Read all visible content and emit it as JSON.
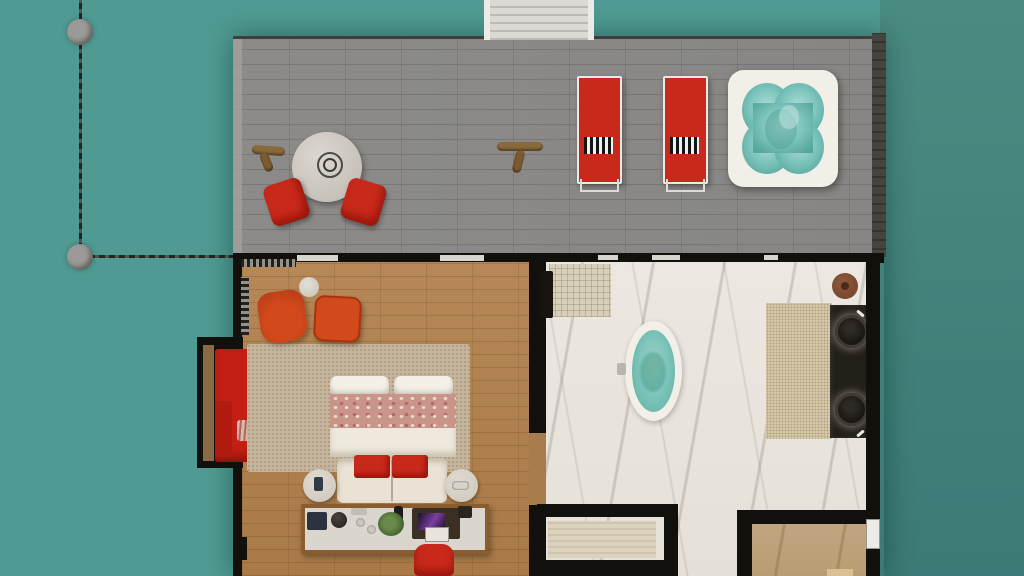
{
  "canvas": {
    "width": 1024,
    "height": 576
  },
  "scene_type": "overwater-villa-top-down-floor-plan-render",
  "inventory": {
    "water": [
      "pier-railing",
      "mooring-pile",
      "mooring-pile"
    ],
    "sun_deck": [
      "entry-staircase",
      "dock-cleat",
      "dock-cleat",
      "bistro-table",
      "cube-chair",
      "cube-chair",
      "sun-lounger",
      "sun-lounger",
      "towel",
      "towel",
      "hot-tub"
    ],
    "bedroom": [
      "sliding-door-gap",
      "sliding-door-gap",
      "blind-hatch",
      "armchair",
      "ottoman",
      "side-table",
      "window-alcove",
      "chaise-lounge",
      "chaise-pillow",
      "round-side-table",
      "area-rug",
      "double-bed",
      "pillow",
      "pillow",
      "floral-runner",
      "duvet",
      "red-cushion",
      "red-cushion",
      "foot-bench",
      "nightstand",
      "nightstand",
      "phone",
      "game-controller",
      "console-desk",
      "coffee-machine",
      "kettle",
      "tray",
      "cup",
      "cup",
      "bottle",
      "plant",
      "tv-screen",
      "mini-fridge",
      "desk-chair"
    ],
    "bathroom": [
      "shower-mat",
      "towel-rack",
      "freestanding-bathtub",
      "tub-faucet",
      "bath-rug",
      "double-vanity",
      "vessel-sink",
      "vessel-sink",
      "faucet",
      "faucet",
      "wooden-stool",
      "storage-bench",
      "hallway",
      "side-room",
      "exterior-door"
    ]
  },
  "colors": {
    "water-left": "#4F9B93",
    "water-right-a": "#4A8B81",
    "water-right-b": "#3B7A76",
    "railing": "#23231F",
    "piling": "#9C9A96",
    "deck": "#8C8B89",
    "deck-edge": "#A3A19D",
    "deck-trim": "#45443F",
    "stairs": "#DCD9D4",
    "stair-stringer": "#EDEBE7",
    "cleat": "#8A6A3A",
    "wall": "#12100D",
    "wood-floor": "#B68857",
    "marble-floor": "#ECE8E1",
    "tan-marble": "#C0A67F",
    "rug-bedroom": "#C6B59D",
    "rug-bath": "#D5C7AA",
    "red": "#C8291A",
    "red-dark": "#C41F14",
    "orange": "#D2491C",
    "cream": "#F2EFE8",
    "pillow": "#F4F0E8",
    "duvet": "#EFE9DD",
    "floral": "#C9948A",
    "nightstand": "#CCC6BB",
    "desk-wood": "#8B5C2D",
    "desk-top": "#DAD6CE",
    "vanity": "#221E18",
    "stool": "#6E402A",
    "bench": "#DCD3BE",
    "mat": "#D8CFBA",
    "ledge-wood": "#8A6A45",
    "tub-water-light": "#7FC6BE",
    "tub-water-deep": "#5FAE9D"
  }
}
